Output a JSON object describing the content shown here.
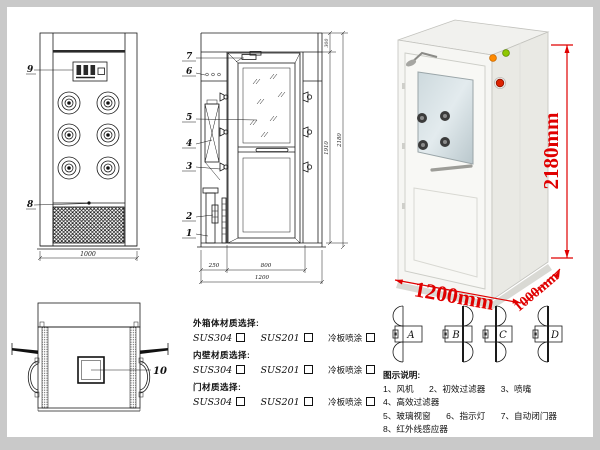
{
  "colors": {
    "line": "#1a1a1a",
    "dim_red": "#e00000",
    "frame_gray": "#c9c9c9"
  },
  "front_view": {
    "label_9": "9",
    "label_8": "8",
    "dim_width": "1000"
  },
  "side_view": {
    "parts": [
      "7",
      "6",
      "5",
      "4",
      "3",
      "2",
      "1"
    ],
    "dim_top": "300",
    "dim_mid": "1910",
    "dim_total": "2180",
    "dim_left": "250",
    "dim_door": "800",
    "dim_width": "1200"
  },
  "top_view": {
    "label_10": "10"
  },
  "photo": {
    "dim_height": "2180mm",
    "dim_width": "1200mm",
    "dim_depth": "1000mm"
  },
  "door_configs": {
    "letters": [
      "A",
      "B",
      "C",
      "D"
    ]
  },
  "materials": {
    "groups": [
      {
        "title": "外箱体材质选择:",
        "options": [
          "SUS304",
          "SUS201",
          "冷板喷涂"
        ]
      },
      {
        "title": "内壁材质选择:",
        "options": [
          "SUS304",
          "SUS201",
          "冷板喷涂"
        ]
      },
      {
        "title": "门材质选择:",
        "options": [
          "SUS304",
          "SUS201",
          "冷板喷涂"
        ]
      }
    ]
  },
  "legend": {
    "title": "图示说明:",
    "items": [
      "1、风机",
      "2、初效过滤器",
      "3、喷嘴",
      "4、高效过滤器",
      "5、玻璃视窗",
      "6、指示灯",
      "7、自动闭门器",
      "8、红外线感应器",
      "9、控制面板",
      "10、照明灯"
    ]
  }
}
